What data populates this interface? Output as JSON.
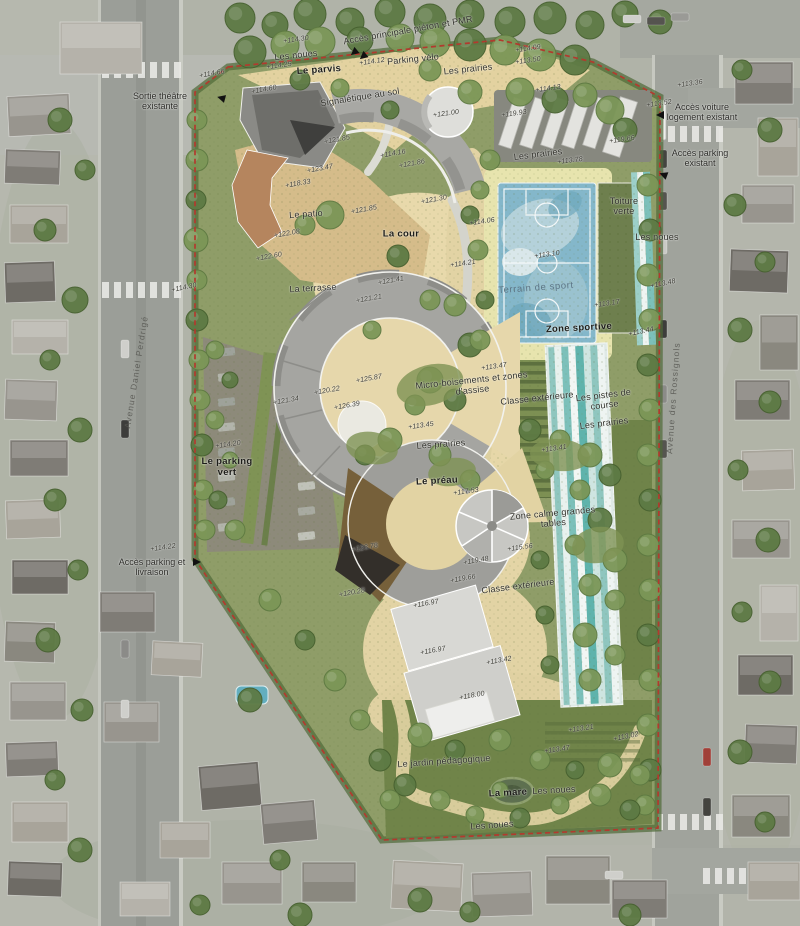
{
  "plan": {
    "colors": {
      "boundary_red": "#b23a2e",
      "sport_court_blue": "#84b7ca",
      "running_track_teal": "#6fbab2",
      "courtyard_sand": "#e5d6a8",
      "prairie_green": "#8f9d68",
      "green_roof": "#6e7f4e",
      "roof_gray": "#a3a3a0",
      "terracotta_roof": "#b5855e"
    }
  },
  "annotations": [
    {
      "t": "Accès principale piéton et PMR",
      "x": 408,
      "y": 30,
      "r": -10,
      "k": "a"
    },
    {
      "t": "+114.30",
      "x": 296,
      "y": 40,
      "r": -8,
      "k": "e"
    },
    {
      "t": "Les noues",
      "x": 296,
      "y": 55,
      "r": -6,
      "k": "a"
    },
    {
      "t": "+114.25",
      "x": 279,
      "y": 66,
      "r": -8,
      "k": "e"
    },
    {
      "t": "Le parvis",
      "x": 319,
      "y": 70,
      "r": -4,
      "k": "b"
    },
    {
      "t": "+114.12",
      "x": 372,
      "y": 62,
      "r": -8,
      "k": "e"
    },
    {
      "t": "Parking vélo",
      "x": 413,
      "y": 59,
      "r": -6,
      "k": "a"
    },
    {
      "t": "Les prairies",
      "x": 468,
      "y": 69,
      "r": -6,
      "k": "a"
    },
    {
      "t": "+114.09",
      "x": 528,
      "y": 49,
      "r": -8,
      "k": "e"
    },
    {
      "t": "+113.50",
      "x": 528,
      "y": 61,
      "r": -8,
      "k": "e"
    },
    {
      "t": "Sortie théâtre existante",
      "x": 160,
      "y": 101,
      "r": 0,
      "k": "ac",
      "w": 78
    },
    {
      "t": "+114.66",
      "x": 212,
      "y": 74,
      "r": -10,
      "k": "e"
    },
    {
      "t": "+114.60",
      "x": 264,
      "y": 90,
      "r": -10,
      "k": "e"
    },
    {
      "t": "Signalétique au sol",
      "x": 360,
      "y": 97,
      "r": -9,
      "k": "a"
    },
    {
      "t": "+121.00",
      "x": 446,
      "y": 114,
      "r": -8,
      "k": "e"
    },
    {
      "t": "+119.93",
      "x": 514,
      "y": 114,
      "r": -8,
      "k": "e"
    },
    {
      "t": "+114.13",
      "x": 548,
      "y": 89,
      "r": -8,
      "k": "e"
    },
    {
      "t": "+113.36",
      "x": 690,
      "y": 84,
      "r": -8,
      "k": "e"
    },
    {
      "t": "+113.52",
      "x": 659,
      "y": 104,
      "r": -8,
      "k": "e"
    },
    {
      "t": "Accès voiture logement existant",
      "x": 702,
      "y": 112,
      "r": 0,
      "k": "ac",
      "w": 72
    },
    {
      "t": "+119.66",
      "x": 622,
      "y": 140,
      "r": -8,
      "k": "e"
    },
    {
      "t": "Accès parking existant",
      "x": 700,
      "y": 158,
      "r": 0,
      "k": "ac",
      "w": 62
    },
    {
      "t": "Les prairies",
      "x": 538,
      "y": 154,
      "r": -7,
      "k": "a"
    },
    {
      "t": "+113.78",
      "x": 570,
      "y": 161,
      "r": -7,
      "k": "e"
    },
    {
      "t": "Toiture verte",
      "x": 624,
      "y": 206,
      "r": 0,
      "k": "a",
      "w": 44
    },
    {
      "t": "Les noues",
      "x": 657,
      "y": 237,
      "r": 0,
      "k": "a"
    },
    {
      "t": "+121.85",
      "x": 337,
      "y": 140,
      "r": -10,
      "k": "e"
    },
    {
      "t": "+114.16",
      "x": 393,
      "y": 154,
      "r": -10,
      "k": "e"
    },
    {
      "t": "+121.86",
      "x": 412,
      "y": 164,
      "r": -10,
      "k": "e"
    },
    {
      "t": "+123.47",
      "x": 320,
      "y": 169,
      "r": -10,
      "k": "e"
    },
    {
      "t": "+118.33",
      "x": 298,
      "y": 184,
      "r": -10,
      "k": "e"
    },
    {
      "t": "Le patio",
      "x": 306,
      "y": 214,
      "r": -4,
      "k": "a"
    },
    {
      "t": "+121.85",
      "x": 364,
      "y": 210,
      "r": -10,
      "k": "e"
    },
    {
      "t": "+121.30",
      "x": 434,
      "y": 200,
      "r": -10,
      "k": "e"
    },
    {
      "t": "La cour",
      "x": 401,
      "y": 234,
      "r": 0,
      "k": "b"
    },
    {
      "t": "+122.08",
      "x": 287,
      "y": 234,
      "r": -10,
      "k": "e"
    },
    {
      "t": "+122.60",
      "x": 269,
      "y": 257,
      "r": -10,
      "k": "e"
    },
    {
      "t": "La terrasse",
      "x": 313,
      "y": 288,
      "r": -3,
      "k": "a"
    },
    {
      "t": "+114.30",
      "x": 184,
      "y": 288,
      "r": -12,
      "k": "e"
    },
    {
      "t": "+121.41",
      "x": 391,
      "y": 281,
      "r": -10,
      "k": "e"
    },
    {
      "t": "+121.21",
      "x": 369,
      "y": 299,
      "r": -10,
      "k": "e"
    },
    {
      "t": "+114.06",
      "x": 482,
      "y": 222,
      "r": -8,
      "k": "e"
    },
    {
      "t": "+114.21",
      "x": 463,
      "y": 264,
      "r": -8,
      "k": "e"
    },
    {
      "t": "+113.10",
      "x": 547,
      "y": 255,
      "r": -8,
      "k": "e"
    },
    {
      "t": "Terrain de sport",
      "x": 536,
      "y": 288,
      "r": -4,
      "k": "al"
    },
    {
      "t": "Zone sportive",
      "x": 579,
      "y": 328,
      "r": -3,
      "k": "b"
    },
    {
      "t": "+113.17",
      "x": 607,
      "y": 304,
      "r": -8,
      "k": "e"
    },
    {
      "t": "+113.48",
      "x": 663,
      "y": 284,
      "r": -12,
      "k": "e"
    },
    {
      "t": "+113.44",
      "x": 641,
      "y": 332,
      "r": -12,
      "k": "e"
    },
    {
      "t": "+113.47",
      "x": 494,
      "y": 367,
      "r": -8,
      "k": "e"
    },
    {
      "t": "Micro-boisements et zones d'assise",
      "x": 472,
      "y": 385,
      "r": -6,
      "k": "a",
      "w": 118
    },
    {
      "t": "Classe extérieure",
      "x": 537,
      "y": 398,
      "r": -6,
      "k": "a"
    },
    {
      "t": "Les pistes de course",
      "x": 604,
      "y": 400,
      "r": -7,
      "k": "a",
      "w": 66
    },
    {
      "t": "Les prairies",
      "x": 604,
      "y": 423,
      "r": -7,
      "k": "a"
    },
    {
      "t": "+125.87",
      "x": 369,
      "y": 379,
      "r": -10,
      "k": "e"
    },
    {
      "t": "+120.22",
      "x": 327,
      "y": 391,
      "r": -10,
      "k": "e"
    },
    {
      "t": "+121.34",
      "x": 286,
      "y": 401,
      "r": -10,
      "k": "e"
    },
    {
      "t": "+126.39",
      "x": 347,
      "y": 406,
      "r": -10,
      "k": "e"
    },
    {
      "t": "+113.45",
      "x": 421,
      "y": 426,
      "r": -8,
      "k": "e"
    },
    {
      "t": "Les prairies",
      "x": 441,
      "y": 444,
      "r": -4,
      "k": "a"
    },
    {
      "t": "+113.41",
      "x": 554,
      "y": 449,
      "r": -8,
      "k": "e"
    },
    {
      "t": "+114.20",
      "x": 228,
      "y": 445,
      "r": -8,
      "k": "e"
    },
    {
      "t": "Le parking vert",
      "x": 227,
      "y": 467,
      "r": 0,
      "k": "b",
      "w": 56
    },
    {
      "t": "Le préau",
      "x": 437,
      "y": 481,
      "r": -3,
      "k": "b"
    },
    {
      "t": "+117.53",
      "x": 466,
      "y": 492,
      "r": -8,
      "k": "e"
    },
    {
      "t": "Zone calme grandes tables",
      "x": 553,
      "y": 518,
      "r": -5,
      "k": "a",
      "w": 88
    },
    {
      "t": "+115.56",
      "x": 520,
      "y": 548,
      "r": -8,
      "k": "e"
    },
    {
      "t": "+119.48",
      "x": 476,
      "y": 561,
      "r": -10,
      "k": "e"
    },
    {
      "t": "+119.66",
      "x": 463,
      "y": 579,
      "r": -10,
      "k": "e"
    },
    {
      "t": "Classe extérieure",
      "x": 518,
      "y": 586,
      "r": -7,
      "k": "a"
    },
    {
      "t": "+123.78",
      "x": 365,
      "y": 548,
      "r": -10,
      "k": "e"
    },
    {
      "t": "+120.28",
      "x": 352,
      "y": 593,
      "r": -10,
      "k": "e"
    },
    {
      "t": "+116.97",
      "x": 426,
      "y": 604,
      "r": -10,
      "k": "e"
    },
    {
      "t": "+116.97",
      "x": 433,
      "y": 651,
      "r": -10,
      "k": "e"
    },
    {
      "t": "+113.42",
      "x": 499,
      "y": 661,
      "r": -10,
      "k": "e"
    },
    {
      "t": "+118.00",
      "x": 472,
      "y": 696,
      "r": -10,
      "k": "e"
    },
    {
      "t": "+114.22",
      "x": 163,
      "y": 548,
      "r": -8,
      "k": "e"
    },
    {
      "t": "Accès parking et livraison",
      "x": 152,
      "y": 567,
      "r": 0,
      "k": "ac",
      "w": 78
    },
    {
      "t": "+113.21",
      "x": 581,
      "y": 729,
      "r": -8,
      "k": "e"
    },
    {
      "t": "+113.02",
      "x": 626,
      "y": 737,
      "r": -12,
      "k": "e"
    },
    {
      "t": "+113.47",
      "x": 557,
      "y": 750,
      "r": -8,
      "k": "e"
    },
    {
      "t": "Le jardin pédagogique",
      "x": 444,
      "y": 761,
      "r": -4,
      "k": "a"
    },
    {
      "t": "La mare",
      "x": 508,
      "y": 793,
      "r": -3,
      "k": "b"
    },
    {
      "t": "Les noues",
      "x": 554,
      "y": 790,
      "r": -3,
      "k": "a"
    },
    {
      "t": "Les noues",
      "x": 492,
      "y": 825,
      "r": -4,
      "k": "a"
    },
    {
      "t": "Avenue Daniel Perdrigé",
      "x": 136,
      "y": 372,
      "r": -81,
      "k": "s"
    },
    {
      "t": "Avenue des Rossignols",
      "x": 673,
      "y": 398,
      "r": -86,
      "k": "s"
    }
  ]
}
